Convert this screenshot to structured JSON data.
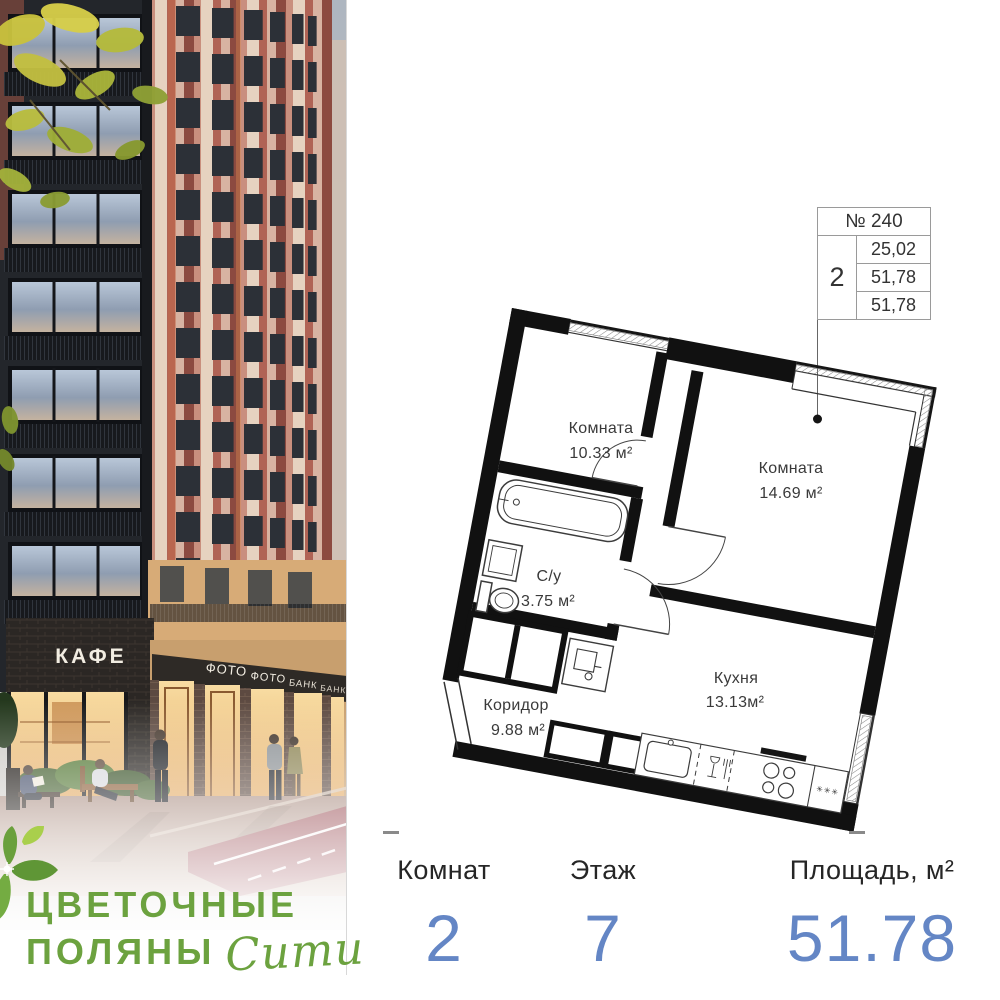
{
  "logo": {
    "line1": "ЦВЕТОЧНЫЕ",
    "line2": "ПОЛЯНЫ",
    "script": "Сити"
  },
  "photo": {
    "signs": {
      "cafe": "КАФЕ",
      "shops": [
        "ФОТО",
        "ФОТО",
        "БАНК",
        "БАНК"
      ]
    }
  },
  "info_table": {
    "number": "№ 240",
    "rooms": "2",
    "values": [
      "25,02",
      "51,78",
      "51,78"
    ]
  },
  "floor_plan": {
    "rooms": [
      {
        "name": "Комната",
        "area": "10.33 м²"
      },
      {
        "name": "Комната",
        "area": "14.69 м²"
      },
      {
        "name": "С/у",
        "area": "3.75 м²"
      },
      {
        "name": "Коридор",
        "area": "9.88 м²"
      },
      {
        "name": "Кухня",
        "area": "13.13м²"
      }
    ],
    "fridge_marks": "✳✳✳"
  },
  "stats": {
    "columns": [
      {
        "label": "Комнат",
        "value": "2"
      },
      {
        "label": "Этаж",
        "value": "7"
      },
      {
        "label": "Площадь, м²",
        "value": "51.78"
      }
    ]
  },
  "colors": {
    "accent_blue": "#6486c5",
    "logo_green": "#6ca23f"
  }
}
